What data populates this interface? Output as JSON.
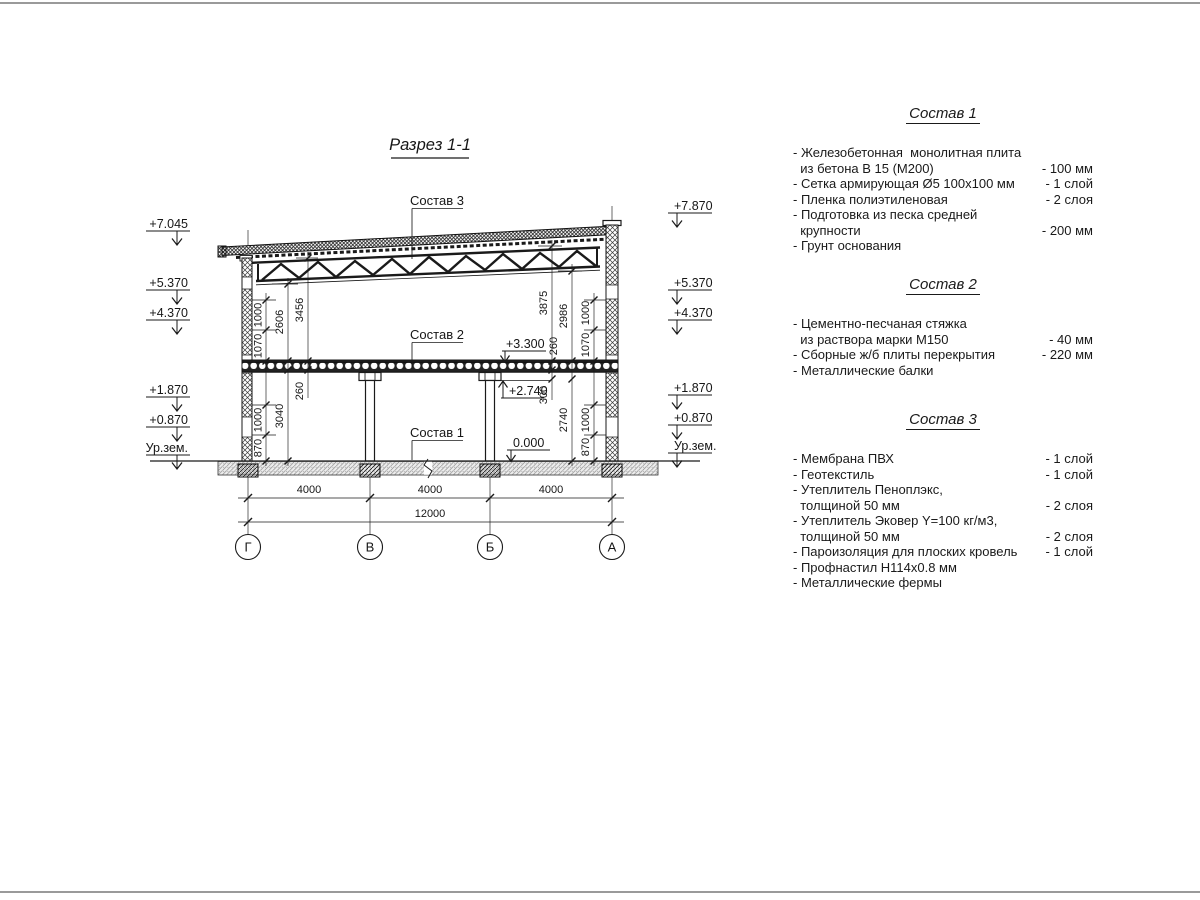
{
  "colors": {
    "line": "#1a1a1a",
    "page_edge": "#9a9a9a",
    "background": "#ffffff"
  },
  "drawing": {
    "title": "Разрез 1-1",
    "callouts": {
      "c1": "Состав 1",
      "c2": "Состав 2",
      "c3": "Состав 3"
    },
    "elev_left": [
      "+7.045",
      "+5.370",
      "+4.370",
      "+1.870",
      "+0.870",
      "Ур.зем."
    ],
    "elev_right": [
      "+7.870",
      "+5.370",
      "+4.370",
      "+1.870",
      "+0.870",
      "Ур.зем."
    ],
    "elev_inner": [
      "+3.300",
      "+2.740",
      "0.000"
    ],
    "dims": {
      "l870": "870",
      "l1000lo": "1000",
      "l1000up": "1000",
      "l1070": "1070",
      "l2606": "2606",
      "l3040": "3040",
      "l3456": "3456",
      "l260": "260",
      "r870": "870",
      "r1000lo": "1000",
      "r1000up": "1000",
      "r1070": "1070",
      "r2986": "2986",
      "r2740": "2740",
      "r3875": "3875",
      "r260": "260",
      "r300": "300"
    },
    "spans": [
      "4000",
      "4000",
      "4000"
    ],
    "total_span": "12000",
    "axes": [
      "Г",
      "В",
      "Б",
      "А"
    ]
  },
  "panel": {
    "sections": [
      {
        "title": "Состав 1",
        "items": [
          {
            "text": "- Железобетонная  монолитная плита\n  из бетона В 15 (М200)",
            "value": "- 100 мм"
          },
          {
            "text": "- Сетка армирующая Ø5 100х100 мм",
            "value": "- 1 слой"
          },
          {
            "text": "- Пленка полиэтиленовая",
            "value": "-  2 слоя"
          },
          {
            "text": "- Подготовка из песка средней\n  крупности",
            "value": "- 200 мм"
          },
          {
            "text": "- Грунт основания",
            "value": ""
          }
        ]
      },
      {
        "title": "Состав 2",
        "items": [
          {
            "text": "- Цементно-песчаная стяжка\n  из раствора марки М150",
            "value": "- 40 мм"
          },
          {
            "text": "- Сборные ж/б плиты перекрытия",
            "value": "- 220 мм"
          },
          {
            "text": "- Металлические балки",
            "value": ""
          }
        ]
      },
      {
        "title": "Состав 3",
        "items": [
          {
            "text": "- Мембрана ПВХ",
            "value": "- 1 слой"
          },
          {
            "text": "- Геотекстиль",
            "value": "- 1 слой"
          },
          {
            "text": "- Утеплитель Пеноплэкс,\n  толщиной 50 мм",
            "value": "- 2 слоя"
          },
          {
            "text": "- Утеплитель Эковер Y=100 кг/м3,\n  толщиной 50 мм",
            "value": "- 2 слоя"
          },
          {
            "text": "- Пароизоляция для плоских кровель",
            "value": "- 1 слой"
          },
          {
            "text": "- Профнастил Н114х0.8 мм",
            "value": ""
          },
          {
            "text": "- Металлические фермы",
            "value": ""
          }
        ]
      }
    ]
  }
}
